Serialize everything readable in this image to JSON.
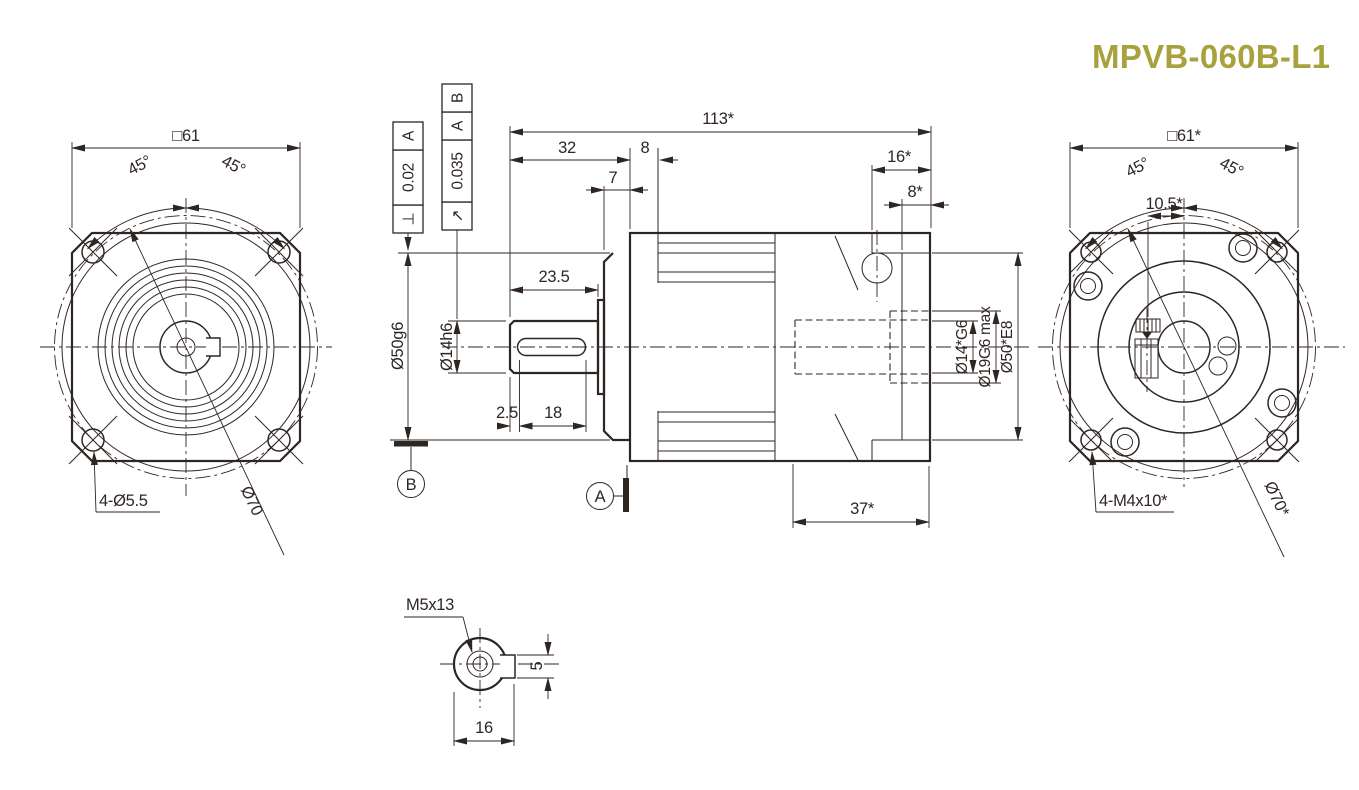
{
  "title": "MPVB-060B-L1",
  "colors": {
    "line": "#2e2623",
    "title_accent": "#a7a23e",
    "background": "#ffffff"
  },
  "front_view": {
    "dim_square": "□61",
    "dim_angle_left": "45°",
    "dim_angle_right": "45°",
    "label_holes": "4-Ø5.5",
    "label_bolt_circle": "Ø70"
  },
  "side_view": {
    "dim_overall": "113*",
    "dim_shaft_len": "32",
    "dim_front_lip": "8",
    "dim_pilot_len": "7",
    "dim_rear_len": "16*",
    "dim_rear_lip": "8*",
    "dim_shaft_usable": "23.5",
    "dim_key_offset": "2.5",
    "dim_key_len": "18",
    "dim_rear_section": "37*",
    "dim_pilot_dia": "Ø50g6",
    "dim_shaft_dia": "Ø14h6",
    "dim_bore_dia": "Ø14*G6",
    "dim_bore_max": "Ø19G6 max",
    "dim_recess_dia": "Ø50*E8",
    "datum_a": "A",
    "datum_b": "B",
    "fcf_perp": {
      "symbol": "⊥",
      "value": "0.02",
      "datum": "A"
    },
    "fcf_runout": {
      "symbol": "↗",
      "value": "0.035",
      "datum_1": "A",
      "datum_2": "B"
    }
  },
  "rear_view": {
    "dim_square": "□61*",
    "dim_angle_left": "45°",
    "dim_angle_right": "45°",
    "dim_screw_offset": "10.5*",
    "label_holes": "4-M4x10*",
    "label_bolt_circle": "Ø70*"
  },
  "shaft_detail": {
    "label_tap": "M5x13",
    "dim_key_width": "5",
    "dim_across_flat": "16"
  }
}
